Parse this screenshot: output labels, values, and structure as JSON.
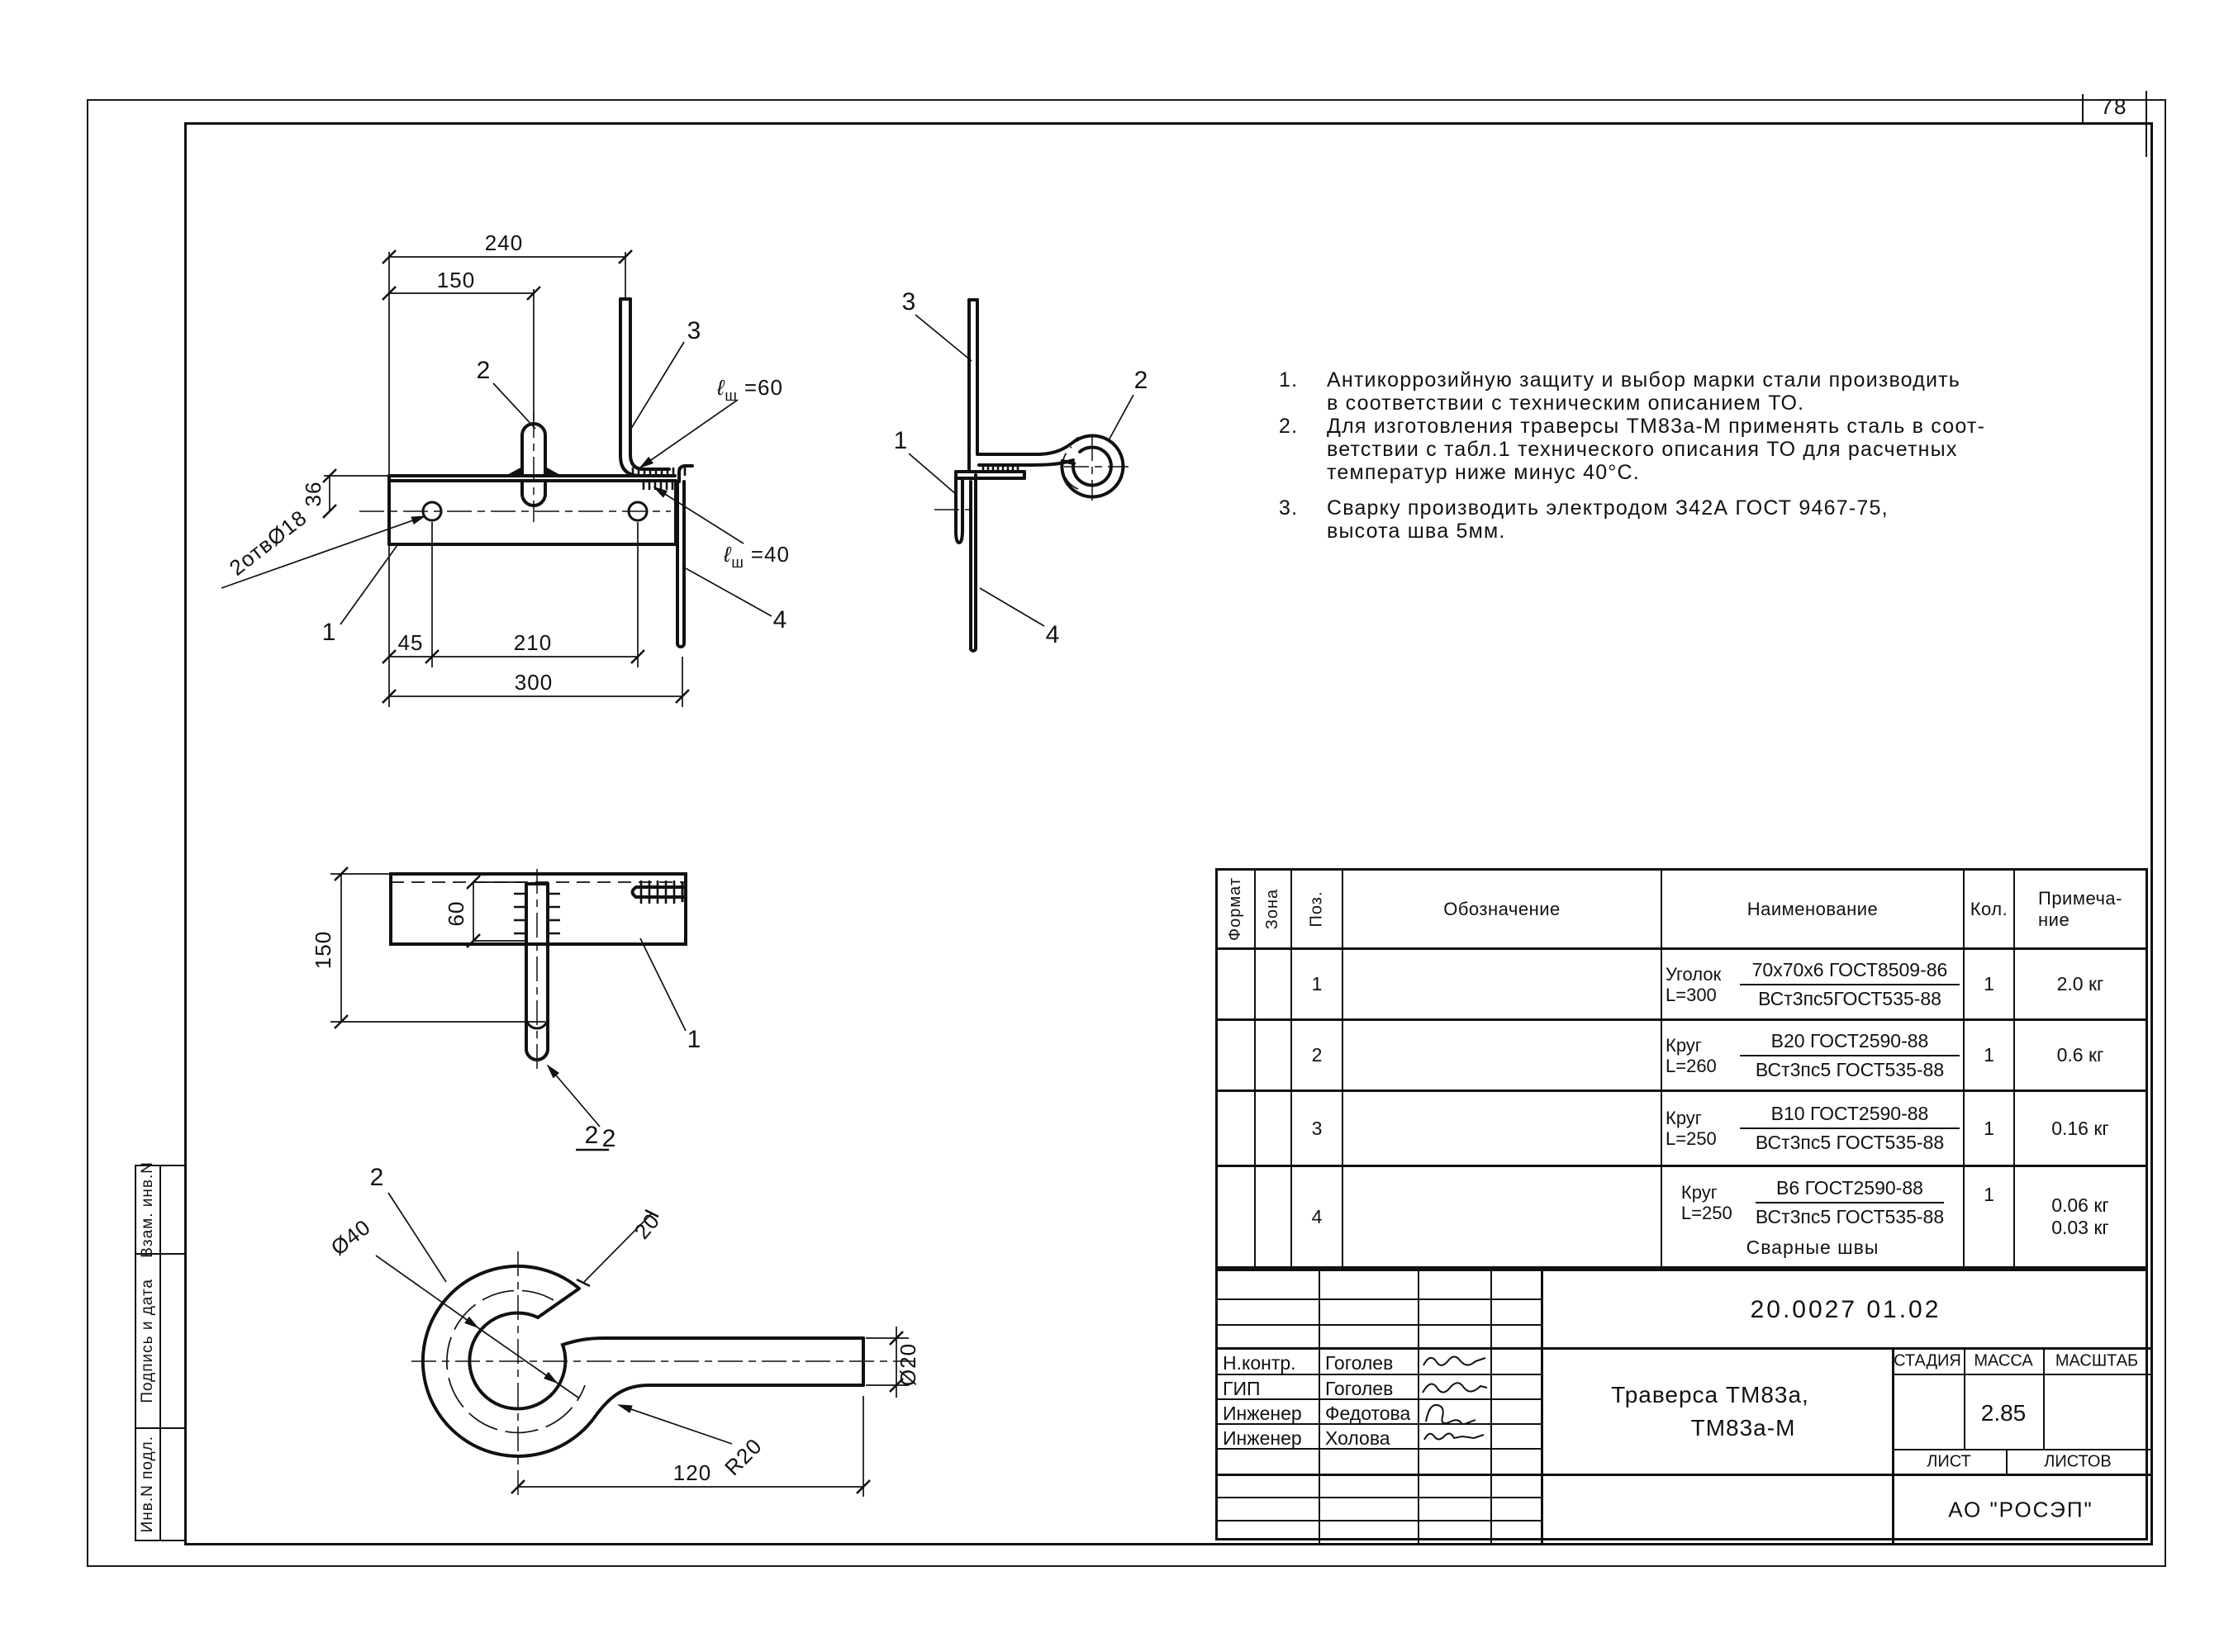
{
  "sheet": {
    "number": "78",
    "org": "АО \"РОСЭП\"",
    "doc_number": "20.0027 01.02",
    "title_line1": "Траверса ТМ83а,",
    "title_line2": "ТМ83а-М",
    "stage_label": "СТАДИЯ",
    "mass_label": "МАССА",
    "scale_label": "МАСШТАБ",
    "mass_value": "2.85",
    "sheet_label": "ЛИСТ",
    "sheets_label": "ЛИСТОВ",
    "people": [
      {
        "role": "Н.контр.",
        "name": "Гоголев"
      },
      {
        "role": "ГИП",
        "name": "Гоголев"
      },
      {
        "role": "Инженер",
        "name": "Федотова"
      },
      {
        "role": "Инженер",
        "name": "Холова"
      }
    ],
    "side_stamps": [
      "Взам. инв.N",
      "Подпись и дата",
      "Инв.N подл."
    ]
  },
  "notes": {
    "items": [
      {
        "num": "1.",
        "lines": [
          "Антикоррозийную защиту и выбор марки стали производить",
          "в соответствии с техническим описанием ТО."
        ]
      },
      {
        "num": "2.",
        "lines": [
          "Для изготовления траверсы ТМ83а-М применять сталь в соот-",
          "ветствии с табл.1 технического описания ТО для расчетных",
          "температур ниже минус 40°С."
        ]
      },
      {
        "num": "3.",
        "lines": [
          "Сварку производить электродом З42А ГОСТ 9467-75,",
          "высота шва 5мм."
        ]
      }
    ]
  },
  "spec_table": {
    "headers": {
      "format": "Формат",
      "zone": "Зона",
      "pos": "Поз.",
      "designation": "Обозначение",
      "name": "Наименование",
      "qty": "Кол.",
      "note_line1": "Примеча-",
      "note_line2": "ние"
    },
    "rows": [
      {
        "pos": "1",
        "prefix": "Уголок",
        "len": "L=300",
        "frac_top": "70х70х6 ГОСТ8509-86",
        "frac_bot": "ВСт3пс5ГОСТ535-88",
        "qty": "1",
        "note": "2.0 кг"
      },
      {
        "pos": "2",
        "prefix": "Круг",
        "len": "L=260",
        "frac_top": "В20 ГОСТ2590-88",
        "frac_bot": "ВСт3пс5 ГОСТ535-88",
        "qty": "1",
        "note": "0.6 кг"
      },
      {
        "pos": "3",
        "prefix": "Круг",
        "len": "L=250",
        "frac_top": "В10 ГОСТ2590-88",
        "frac_bot": "ВСт3пс5 ГОСТ535-88",
        "qty": "1",
        "note": "0.16 кг"
      },
      {
        "pos": "4",
        "prefix": "Круг",
        "len": "L=250",
        "frac_top": "В6 ГОСТ2590-88",
        "frac_bot": "ВСт3пс5 ГОСТ535-88",
        "qty": "1",
        "note": "0.06 кг",
        "extra": "Сварные швы",
        "extra_note": "0.03 кг"
      }
    ]
  },
  "drawing": {
    "view1": {
      "dim_240": "240",
      "dim_150": "150",
      "dim_36": "36",
      "dim_45": "45",
      "dim_210": "210",
      "dim_300": "300",
      "holes": "2отвØ18",
      "ref_1": "1",
      "ref_2": "2",
      "ref_3": "3",
      "ref_4": "4",
      "weld60_sym": "ℓ",
      "weld60_sub": "ш",
      "weld60_val": "=60",
      "weld40_sym": "ℓ",
      "weld40_sub": "ш",
      "weld40_val": "=40"
    },
    "view2": {
      "ref_1": "1",
      "ref_2": "2",
      "ref_3": "3",
      "ref_4": "4"
    },
    "view3": {
      "dim_150": "150",
      "dim_60": "60",
      "ref_1": "1",
      "ref_2": "2"
    },
    "view4": {
      "designator": "2",
      "ref_2": "2",
      "dim_d40": "Ø40",
      "dim_20": "20",
      "dim_r20": "R20",
      "dim_d20": "Ø20",
      "dim_120": "120"
    }
  }
}
